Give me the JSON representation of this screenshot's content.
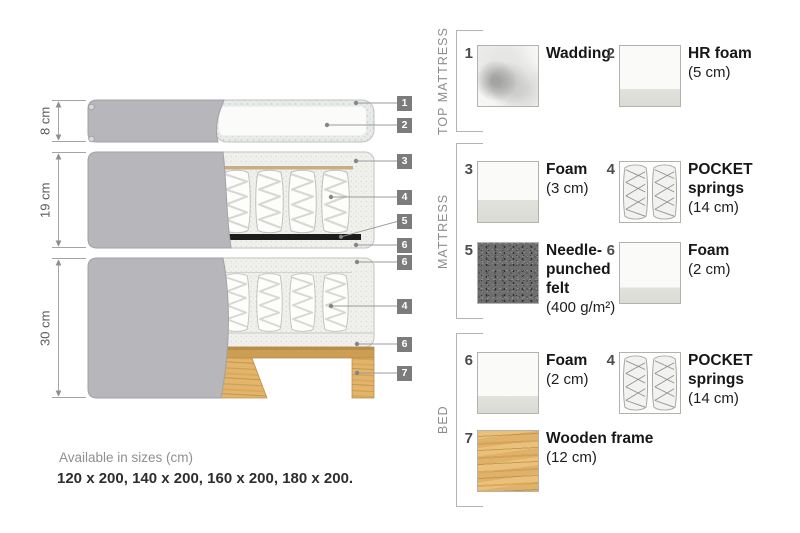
{
  "colors": {
    "fabric_gray": "#b7b6ba",
    "foam_light": "#f0f0ec",
    "wadding_band": "#e7ebea",
    "wood_tan": "#e0b269",
    "felt_dark": "#1c1c1c",
    "callout_badge_gray": "#7c7c7c"
  },
  "diagram": {
    "dim_labels": [
      "8 cm",
      "19 cm",
      "30 cm"
    ],
    "callouts": [
      "1",
      "2",
      "3",
      "4",
      "5",
      "6",
      "6",
      "4",
      "6",
      "7"
    ]
  },
  "legend": {
    "sections": [
      {
        "title": "TOP MATTRESS",
        "items": [
          {
            "num": "1",
            "name": "Wadding",
            "size": ""
          },
          {
            "num": "2",
            "name": "HR foam",
            "size": "(5 cm)"
          }
        ]
      },
      {
        "title": "MATTRESS",
        "items": [
          {
            "num": "3",
            "name": "Foam",
            "size": "(3 cm)"
          },
          {
            "num": "4",
            "name": "POCKET springs",
            "size": "(14 cm)"
          },
          {
            "num": "5",
            "name": "Needle-punched felt",
            "size": "(400 g/m²)"
          },
          {
            "num": "6",
            "name": "Foam",
            "size": "(2 cm)"
          }
        ]
      },
      {
        "title": "BED",
        "items": [
          {
            "num": "6",
            "name": "Foam",
            "size": "(2 cm)"
          },
          {
            "num": "4",
            "name": "POCKET springs",
            "size": "(14 cm)"
          },
          {
            "num": "7",
            "name": "Wooden frame",
            "size": "(12 cm)"
          }
        ]
      }
    ]
  },
  "footer": {
    "sizes_title": "Available in sizes (cm)",
    "sizes_list": "120 x 200, 140 x 200, 160 x 200, 180 x 200."
  }
}
